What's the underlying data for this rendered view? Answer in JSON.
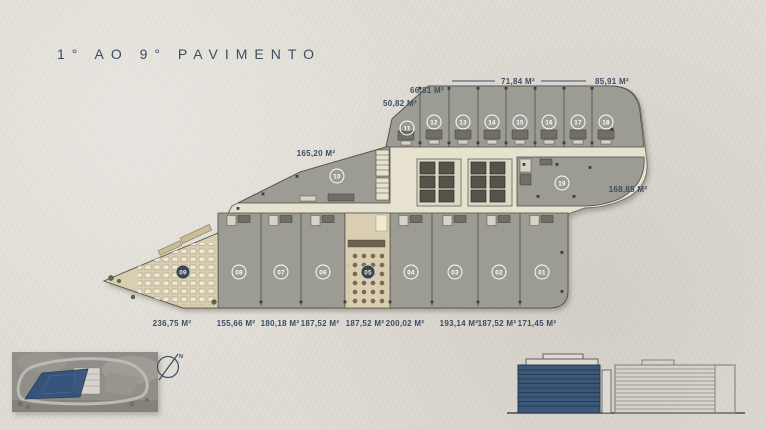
{
  "page": {
    "title": "1° AO 9° PAVIMENTO"
  },
  "plan": {
    "dims_top": [
      "50,82 M²",
      "66,81 M²",
      "71,84 M²",
      "85,91 M²"
    ],
    "dim_left": "165,20 M²",
    "dim_right": "168,85 M²",
    "dims_bottom": [
      "236,75 M²",
      "155,66 M²",
      "180,18 M²",
      "187,52 M²",
      "187,52 M²",
      "200,02 M²",
      "193,14 M²",
      "187,52 M²",
      "171,45 M²"
    ],
    "units_top": [
      "11",
      "12",
      "13",
      "14",
      "15",
      "16",
      "17",
      "18"
    ],
    "unit_mid_left": "10",
    "unit_mid_right": "19",
    "units_bottom": [
      "09",
      "08",
      "07",
      "06",
      "05",
      "04",
      "03",
      "02",
      "01"
    ]
  },
  "compass": {
    "north_label": "N"
  },
  "colors": {
    "accent_text": "#3d4d62",
    "unit_fill": "#9c9c94",
    "corridor_fill": "#e7e1cf",
    "terrace_fill": "#d9ceb1",
    "highlight_blue": "#3b5878",
    "site_polygon_blue": "#2f4e78",
    "background": "#e0dcd5"
  }
}
